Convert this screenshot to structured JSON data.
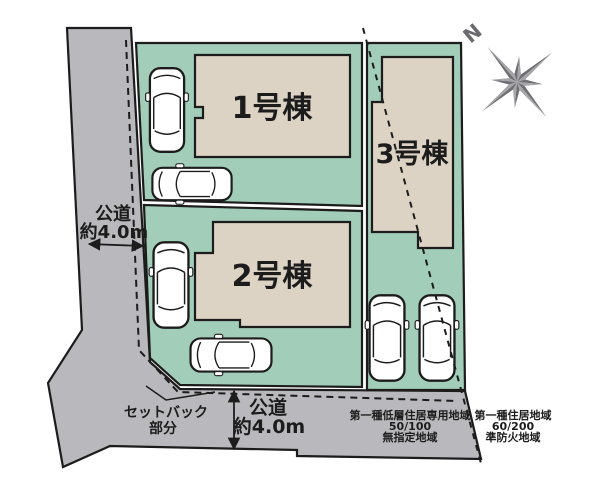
{
  "buildings": [
    {
      "label": "1号棟"
    },
    {
      "label": "2号棟"
    },
    {
      "label": "3号棟"
    }
  ],
  "roads": {
    "left": {
      "name": "公道",
      "width": "約4.0m"
    },
    "bottom": {
      "name": "公道",
      "width": "約4.0m"
    }
  },
  "setback": {
    "line1": "セットバック",
    "line2": "部分"
  },
  "zoning": {
    "left": {
      "lines": [
        "第一種低層住居専用地域",
        "50/100",
        "無指定地域"
      ]
    },
    "right": {
      "lines": [
        "第一種住居地域",
        "60/200",
        "準防火地域"
      ]
    }
  },
  "compass": {
    "north_label": "N"
  },
  "colors": {
    "road": "#b9b8bc",
    "plot": "#a2cdb9",
    "building": "#ddd3c4",
    "outline": "#1c1c1c",
    "compass_dark": "#6f6f73",
    "compass_light": "#a6a6aa"
  }
}
